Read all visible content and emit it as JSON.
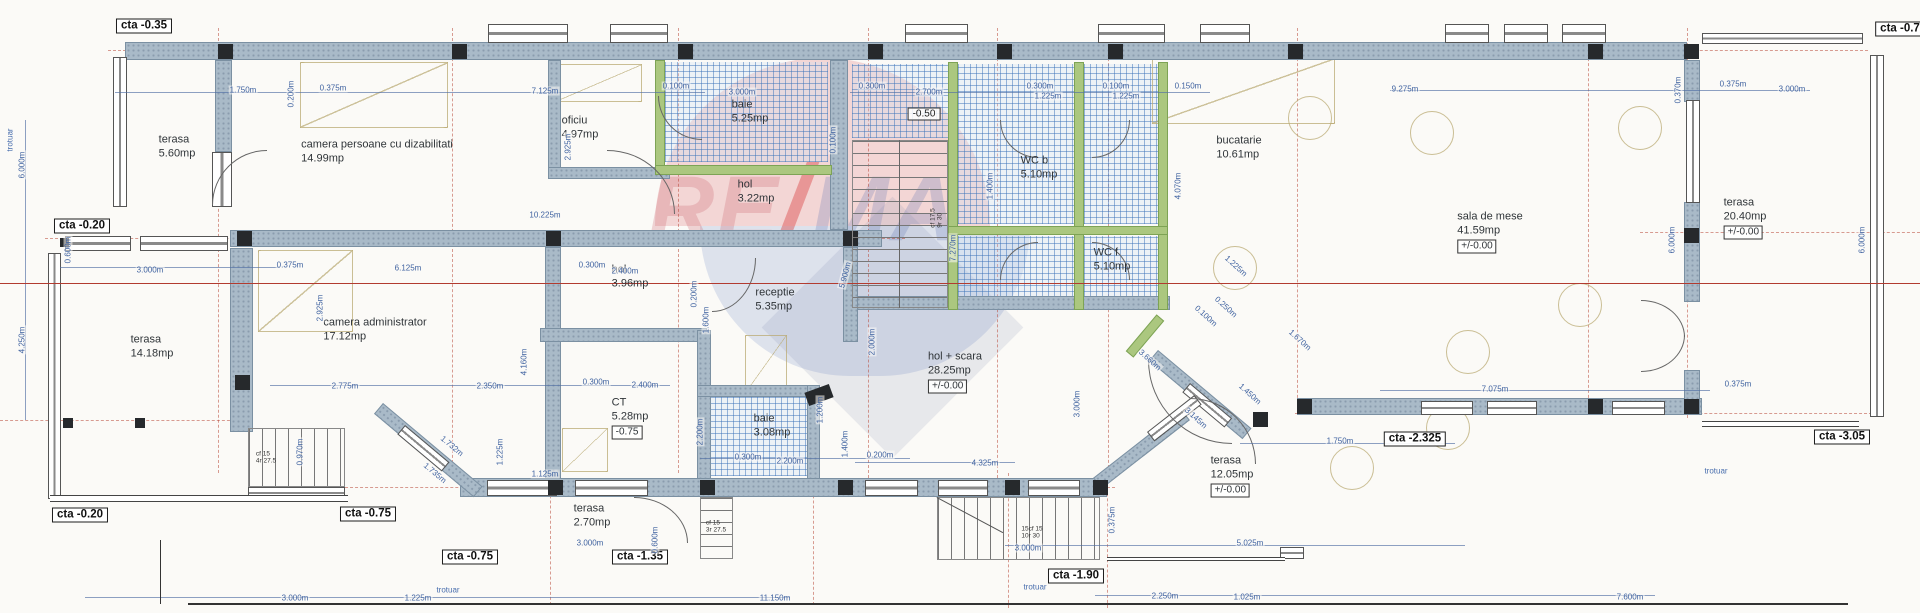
{
  "plan": {
    "colors": {
      "wall": "#a9bac8",
      "wall_green": "#abc77f",
      "column": "#26292c",
      "hatch_blue": "#3c73b9",
      "dimension_blue": "#3f62a0",
      "red_section_line": "#b23b30",
      "watermark_red": "#d54650",
      "watermark_blue": "#5069b9"
    },
    "watermark": {
      "left": "RE",
      "slash": "/",
      "right": "MA"
    },
    "rooms": [
      {
        "name": "terasa",
        "area": "5.60mp",
        "x": 177,
        "y": 147
      },
      {
        "name": "camera persoane cu dizabilitati",
        "area": "14.99mp",
        "x": 377,
        "y": 152
      },
      {
        "name": "oficiu",
        "area": "4.97mp",
        "x": 580,
        "y": 128
      },
      {
        "name": "baie",
        "area": "5.25mp",
        "x": 750,
        "y": 112
      },
      {
        "name": "hol",
        "area": "3.22mp",
        "x": 756,
        "y": 192
      },
      {
        "name": "WC b",
        "area": "5.10mp",
        "x": 1039,
        "y": 168
      },
      {
        "name": "WC f",
        "area": "5.10mp",
        "x": 1112,
        "y": 260
      },
      {
        "name": "bucatarie",
        "area": "10.61mp",
        "x": 1239,
        "y": 148
      },
      {
        "name": "sala de mese",
        "area": "41.59mp",
        "elev": "+/-0.00",
        "x": 1490,
        "y": 232
      },
      {
        "name": "terasa",
        "area": "20.40mp",
        "elev": "+/-0.00",
        "x": 1745,
        "y": 218
      },
      {
        "name": "terasa",
        "area": "14.18mp",
        "x": 152,
        "y": 347
      },
      {
        "name": "camera administrator",
        "area": "17.12mp",
        "x": 375,
        "y": 330
      },
      {
        "name": "hol",
        "area": "3.96mp",
        "x": 630,
        "y": 277
      },
      {
        "name": "receptie",
        "area": "5.35mp",
        "x": 775,
        "y": 300
      },
      {
        "name": "CT",
        "area": "5.28mp",
        "elev": "-0.75",
        "x": 630,
        "y": 418
      },
      {
        "name": "baie",
        "area": "3.08mp",
        "x": 772,
        "y": 426
      },
      {
        "name": "hol + scara",
        "area": "28.25mp",
        "elev": "+/-0.00",
        "x": 955,
        "y": 372
      },
      {
        "name": "terasa",
        "area": "2.70mp",
        "x": 592,
        "y": 516
      },
      {
        "name": "terasa",
        "area": "12.05mp",
        "elev": "+/-0.00",
        "x": 1232,
        "y": 476
      }
    ],
    "level_markers": [
      {
        "text": "cta -0.35",
        "x": 144,
        "y": 26
      },
      {
        "text": "cta -0.20",
        "x": 82,
        "y": 226
      },
      {
        "text": "cta -0.20",
        "x": 80,
        "y": 515
      },
      {
        "text": "cta -0.75",
        "x": 368,
        "y": 514
      },
      {
        "text": "cta -0.75",
        "x": 470,
        "y": 557
      },
      {
        "text": "cta -1.35",
        "x": 640,
        "y": 557
      },
      {
        "text": "cta -1.90",
        "x": 1076,
        "y": 576
      },
      {
        "text": "cta -2.325",
        "x": 1415,
        "y": 439
      },
      {
        "text": "cta -3.05",
        "x": 1842,
        "y": 437
      },
      {
        "text": "cta -0.7",
        "x": 1900,
        "y": 29
      }
    ],
    "spot_elevations": [
      {
        "text": "-0.50",
        "x": 924,
        "y": 114
      }
    ],
    "dimensions": [
      {
        "t": "1.750m",
        "x": 243,
        "y": 90
      },
      {
        "t": "0.375m",
        "x": 333,
        "y": 88
      },
      {
        "t": "0.200m",
        "x": 291,
        "y": 94,
        "r": -90
      },
      {
        "t": "7.125m",
        "x": 545,
        "y": 91
      },
      {
        "t": "2.925m",
        "x": 568,
        "y": 147,
        "r": -90
      },
      {
        "t": "0.100m",
        "x": 676,
        "y": 86
      },
      {
        "t": "3.000m",
        "x": 742,
        "y": 92
      },
      {
        "t": "0.100m",
        "x": 833,
        "y": 140,
        "r": -90
      },
      {
        "t": "0.300m",
        "x": 872,
        "y": 86
      },
      {
        "t": "2.700m",
        "x": 929,
        "y": 92
      },
      {
        "t": "0.300m",
        "x": 1040,
        "y": 86
      },
      {
        "t": "1.225m",
        "x": 1048,
        "y": 96
      },
      {
        "t": "0.100m",
        "x": 1116,
        "y": 86
      },
      {
        "t": "1.225m",
        "x": 1126,
        "y": 96
      },
      {
        "t": "0.150m",
        "x": 1188,
        "y": 86
      },
      {
        "t": "9.275m",
        "x": 1405,
        "y": 89
      },
      {
        "t": "0.375m",
        "x": 1733,
        "y": 84
      },
      {
        "t": "3.000m",
        "x": 1792,
        "y": 89
      },
      {
        "t": "0.370m",
        "x": 1678,
        "y": 90,
        "r": -90
      },
      {
        "t": "6.000m",
        "x": 22,
        "y": 165,
        "r": -90
      },
      {
        "t": "0.600m",
        "x": 68,
        "y": 250,
        "r": -90
      },
      {
        "t": "4.250m",
        "x": 22,
        "y": 340,
        "r": -90
      },
      {
        "t": "3.000m",
        "x": 150,
        "y": 270
      },
      {
        "t": "0.375m",
        "x": 290,
        "y": 265
      },
      {
        "t": "6.125m",
        "x": 408,
        "y": 268
      },
      {
        "t": "10.225m",
        "x": 545,
        "y": 215
      },
      {
        "t": "0.300m",
        "x": 592,
        "y": 265
      },
      {
        "t": "2.400m",
        "x": 625,
        "y": 271
      },
      {
        "t": "0.200m",
        "x": 694,
        "y": 294,
        "r": -90
      },
      {
        "t": "1.600m",
        "x": 706,
        "y": 320,
        "r": -90
      },
      {
        "t": "5.900m",
        "x": 845,
        "y": 275,
        "r": -75
      },
      {
        "t": "2.000m",
        "x": 872,
        "y": 342,
        "r": -90
      },
      {
        "t": "7.270m",
        "x": 953,
        "y": 248,
        "r": -90
      },
      {
        "t": "2.925m",
        "x": 320,
        "y": 308,
        "r": -90
      },
      {
        "t": "2.775m",
        "x": 345,
        "y": 386
      },
      {
        "t": "2.350m",
        "x": 490,
        "y": 386
      },
      {
        "t": "4.160m",
        "x": 524,
        "y": 362,
        "r": -90
      },
      {
        "t": "0.300m",
        "x": 596,
        "y": 382
      },
      {
        "t": "2.400m",
        "x": 645,
        "y": 385
      },
      {
        "t": "2.200m",
        "x": 700,
        "y": 432,
        "r": -90
      },
      {
        "t": "1.732m",
        "x": 452,
        "y": 446,
        "r": 40
      },
      {
        "t": "1.735m",
        "x": 435,
        "y": 473,
        "r": 40
      },
      {
        "t": "1.225m",
        "x": 500,
        "y": 452,
        "r": -90
      },
      {
        "t": "1.125m",
        "x": 545,
        "y": 474
      },
      {
        "t": "0.300m",
        "x": 748,
        "y": 457
      },
      {
        "t": "2.200m",
        "x": 790,
        "y": 461
      },
      {
        "t": "0.200m",
        "x": 880,
        "y": 455
      },
      {
        "t": "1.200m",
        "x": 820,
        "y": 410,
        "r": -90
      },
      {
        "t": "1.400m",
        "x": 845,
        "y": 444,
        "r": -90
      },
      {
        "t": "1.400m",
        "x": 990,
        "y": 186,
        "r": -90
      },
      {
        "t": "4.070m",
        "x": 1178,
        "y": 186,
        "r": -90
      },
      {
        "t": "1.225m",
        "x": 1236,
        "y": 266,
        "r": 42
      },
      {
        "t": "4.325m",
        "x": 985,
        "y": 463
      },
      {
        "t": "3.000m",
        "x": 1077,
        "y": 404,
        "r": -90
      },
      {
        "t": "3.660m",
        "x": 1150,
        "y": 360,
        "r": 42
      },
      {
        "t": "3.145m",
        "x": 1196,
        "y": 418,
        "r": 42
      },
      {
        "t": "1.450m",
        "x": 1250,
        "y": 394,
        "r": 42
      },
      {
        "t": "1.670m",
        "x": 1300,
        "y": 340,
        "r": 42
      },
      {
        "t": "0.100m",
        "x": 1206,
        "y": 316,
        "r": 42
      },
      {
        "t": "0.250m",
        "x": 1226,
        "y": 307,
        "r": 42
      },
      {
        "t": "1.750m",
        "x": 1340,
        "y": 441
      },
      {
        "t": "7.075m",
        "x": 1495,
        "y": 389
      },
      {
        "t": "0.375m",
        "x": 1738,
        "y": 384
      },
      {
        "t": "6.000m",
        "x": 1672,
        "y": 240,
        "r": -90
      },
      {
        "t": "6.000m",
        "x": 1862,
        "y": 240,
        "r": -90
      },
      {
        "t": "0.375m",
        "x": 1112,
        "y": 520,
        "r": -90
      },
      {
        "t": "5.025m",
        "x": 1250,
        "y": 543
      },
      {
        "t": "3.000m",
        "x": 1028,
        "y": 548
      },
      {
        "t": "3.000m",
        "x": 590,
        "y": 543
      },
      {
        "t": "0.600m",
        "x": 655,
        "y": 540,
        "r": -90
      },
      {
        "t": "0.970m",
        "x": 300,
        "y": 452,
        "r": -90
      },
      {
        "t": "3.000m",
        "x": 295,
        "y": 598
      },
      {
        "t": "1.225m",
        "x": 418,
        "y": 598
      },
      {
        "t": "11.150m",
        "x": 775,
        "y": 598
      },
      {
        "t": "2.250m",
        "x": 1165,
        "y": 596
      },
      {
        "t": "1.025m",
        "x": 1247,
        "y": 597
      },
      {
        "t": "7.600m",
        "x": 1630,
        "y": 597
      }
    ],
    "annotations": [
      {
        "t": "trotuar",
        "x": 448,
        "y": 590
      },
      {
        "t": "trotuar",
        "x": 1035,
        "y": 587
      },
      {
        "t": "trotuar",
        "x": 1716,
        "y": 471
      },
      {
        "t": "trotuar",
        "x": 10,
        "y": 140,
        "r": -90
      }
    ],
    "stair_notes": [
      {
        "t": "cf 15\n4r 27.5",
        "x": 266,
        "y": 458
      },
      {
        "t": "cf 15\n3r 27.5",
        "x": 716,
        "y": 527
      },
      {
        "t": "15cf 15\n10r 30",
        "x": 1032,
        "y": 533
      },
      {
        "t": "cf 17.5\n9r 30",
        "x": 937,
        "y": 218,
        "r": -90
      }
    ]
  }
}
